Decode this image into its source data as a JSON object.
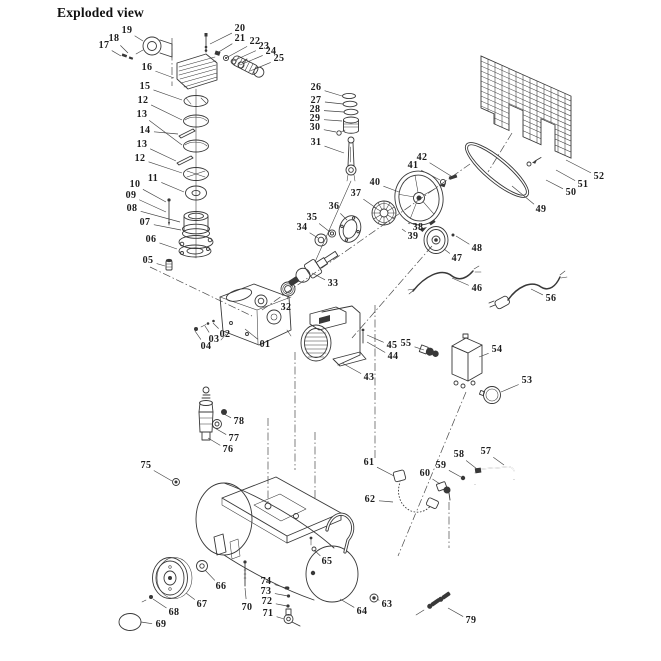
{
  "title": "Exploded view",
  "diagram": {
    "type": "exploded-parts-diagram",
    "subject": "belt-driven air compressor with horizontal tank",
    "ink_color": "#383838",
    "background_color": "#ffffff",
    "labels": [
      {
        "t": "17",
        "x": 104,
        "y": 46,
        "tx": 121,
        "ty": 56
      },
      {
        "t": "18",
        "x": 114,
        "y": 39,
        "tx": 128,
        "ty": 53
      },
      {
        "t": "19",
        "x": 127,
        "y": 31,
        "tx": 143,
        "ty": 41
      },
      {
        "t": "16",
        "x": 147,
        "y": 68,
        "tx": 174,
        "ty": 78
      },
      {
        "t": "15",
        "x": 145,
        "y": 87,
        "tx": 182,
        "ty": 100
      },
      {
        "t": "12",
        "x": 143,
        "y": 101,
        "tx": 182,
        "ty": 120
      },
      {
        "t": "13",
        "x": 142,
        "y": 115,
        "tx": 182,
        "ty": 145
      },
      {
        "t": "14",
        "x": 145,
        "y": 131,
        "tx": 178,
        "ty": 134
      },
      {
        "t": "13",
        "x": 142,
        "y": 145,
        "tx": 176,
        "ty": 161
      },
      {
        "t": "12",
        "x": 140,
        "y": 159,
        "tx": 182,
        "ty": 173
      },
      {
        "t": "11",
        "x": 153,
        "y": 179,
        "tx": 184,
        "ty": 192
      },
      {
        "t": "10",
        "x": 135,
        "y": 185,
        "tx": 166,
        "ty": 202
      },
      {
        "t": "09",
        "x": 131,
        "y": 196,
        "tx": 166,
        "ty": 212
      },
      {
        "t": "08",
        "x": 132,
        "y": 209,
        "tx": 180,
        "ty": 222
      },
      {
        "t": "07",
        "x": 145,
        "y": 223,
        "tx": 181,
        "ty": 230
      },
      {
        "t": "06",
        "x": 151,
        "y": 240,
        "tx": 177,
        "ty": 249
      },
      {
        "t": "05",
        "x": 148,
        "y": 261,
        "tx": 165,
        "ty": 266
      },
      {
        "t": "20",
        "x": 240,
        "y": 29,
        "tx": 210,
        "ty": 44
      },
      {
        "t": "21",
        "x": 240,
        "y": 39,
        "tx": 217,
        "ty": 53
      },
      {
        "t": "22",
        "x": 255,
        "y": 42,
        "tx": 226,
        "ty": 58
      },
      {
        "t": "23",
        "x": 264,
        "y": 47,
        "tx": 233,
        "ty": 61
      },
      {
        "t": "24",
        "x": 271,
        "y": 52,
        "tx": 240,
        "ty": 65
      },
      {
        "t": "25",
        "x": 279,
        "y": 59,
        "tx": 250,
        "ty": 71
      },
      {
        "t": "26",
        "x": 316,
        "y": 88,
        "tx": 342,
        "ty": 96
      },
      {
        "t": "27",
        "x": 316,
        "y": 101,
        "tx": 343,
        "ty": 104
      },
      {
        "t": "28",
        "x": 315,
        "y": 110,
        "tx": 344,
        "ty": 112
      },
      {
        "t": "29",
        "x": 315,
        "y": 119,
        "tx": 342,
        "ty": 121
      },
      {
        "t": "30",
        "x": 315,
        "y": 128,
        "tx": 336,
        "ty": 132
      },
      {
        "t": "31",
        "x": 316,
        "y": 143,
        "tx": 344,
        "ty": 153
      },
      {
        "t": "32",
        "x": 286,
        "y": 308,
        "tx": 288,
        "ty": 296
      },
      {
        "t": "33",
        "x": 333,
        "y": 284,
        "tx": 312,
        "ty": 273
      },
      {
        "t": "34",
        "x": 302,
        "y": 228,
        "tx": 318,
        "ty": 238
      },
      {
        "t": "35",
        "x": 312,
        "y": 218,
        "tx": 330,
        "ty": 232
      },
      {
        "t": "36",
        "x": 334,
        "y": 207,
        "tx": 347,
        "ty": 220
      },
      {
        "t": "37",
        "x": 356,
        "y": 194,
        "tx": 376,
        "ty": 208
      },
      {
        "t": "38",
        "x": 418,
        "y": 228,
        "tx": 408,
        "ty": 223
      },
      {
        "t": "39",
        "x": 413,
        "y": 237,
        "tx": 402,
        "ty": 229
      },
      {
        "t": "40",
        "x": 375,
        "y": 183,
        "tx": 399,
        "ty": 192
      },
      {
        "t": "41",
        "x": 413,
        "y": 166,
        "tx": 440,
        "ty": 180
      },
      {
        "t": "42",
        "x": 422,
        "y": 158,
        "tx": 451,
        "ty": 176
      },
      {
        "t": "43",
        "x": 369,
        "y": 378,
        "tx": 342,
        "ty": 363
      },
      {
        "t": "44",
        "x": 393,
        "y": 357,
        "tx": 367,
        "ty": 342
      },
      {
        "t": "45",
        "x": 392,
        "y": 346,
        "tx": 367,
        "ty": 335
      },
      {
        "t": "46",
        "x": 477,
        "y": 289,
        "tx": 452,
        "ty": 278
      },
      {
        "t": "47",
        "x": 457,
        "y": 259,
        "tx": 444,
        "ty": 249
      },
      {
        "t": "48",
        "x": 477,
        "y": 249,
        "tx": 456,
        "ty": 236
      },
      {
        "t": "49",
        "x": 541,
        "y": 210,
        "tx": 512,
        "ty": 186
      },
      {
        "t": "50",
        "x": 571,
        "y": 193,
        "tx": 546,
        "ty": 180
      },
      {
        "t": "51",
        "x": 583,
        "y": 185,
        "tx": 556,
        "ty": 170
      },
      {
        "t": "52",
        "x": 599,
        "y": 177,
        "tx": 566,
        "ty": 160
      },
      {
        "t": "53",
        "x": 527,
        "y": 381,
        "tx": 501,
        "ty": 392
      },
      {
        "t": "54",
        "x": 497,
        "y": 350,
        "tx": 479,
        "ty": 357
      },
      {
        "t": "55",
        "x": 406,
        "y": 344,
        "tx": 424,
        "ty": 350
      },
      {
        "t": "56",
        "x": 551,
        "y": 299,
        "tx": 531,
        "ty": 289
      },
      {
        "t": "57",
        "x": 486,
        "y": 452,
        "tx": 504,
        "ty": 465
      },
      {
        "t": "58",
        "x": 459,
        "y": 455,
        "tx": 477,
        "ty": 469
      },
      {
        "t": "59",
        "x": 441,
        "y": 466,
        "tx": 461,
        "ty": 477
      },
      {
        "t": "60",
        "x": 425,
        "y": 474,
        "tx": 440,
        "ty": 484
      },
      {
        "t": "61",
        "x": 369,
        "y": 463,
        "tx": 394,
        "ty": 476
      },
      {
        "t": "62",
        "x": 370,
        "y": 500,
        "tx": 393,
        "ty": 502
      },
      {
        "t": "63",
        "x": 387,
        "y": 605,
        "tx": 377,
        "ty": 599
      },
      {
        "t": "64",
        "x": 362,
        "y": 612,
        "tx": 340,
        "ty": 599
      },
      {
        "t": "65",
        "x": 327,
        "y": 562,
        "tx": 314,
        "ty": 550
      },
      {
        "t": "66",
        "x": 221,
        "y": 587,
        "tx": 205,
        "ty": 570
      },
      {
        "t": "67",
        "x": 202,
        "y": 605,
        "tx": 186,
        "ty": 593
      },
      {
        "t": "68",
        "x": 174,
        "y": 613,
        "tx": 153,
        "ty": 599
      },
      {
        "t": "69",
        "x": 161,
        "y": 625,
        "tx": 141,
        "ty": 622
      },
      {
        "t": "70",
        "x": 247,
        "y": 608,
        "tx": 245,
        "ty": 588
      },
      {
        "t": "71",
        "x": 268,
        "y": 614,
        "tx": 284,
        "ty": 619
      },
      {
        "t": "72",
        "x": 267,
        "y": 602,
        "tx": 287,
        "ty": 606
      },
      {
        "t": "73",
        "x": 266,
        "y": 592,
        "tx": 288,
        "ty": 596
      },
      {
        "t": "74",
        "x": 266,
        "y": 582,
        "tx": 286,
        "ty": 588
      },
      {
        "t": "75",
        "x": 146,
        "y": 466,
        "tx": 172,
        "ty": 481
      },
      {
        "t": "76",
        "x": 228,
        "y": 450,
        "tx": 208,
        "ty": 438
      },
      {
        "t": "77",
        "x": 234,
        "y": 439,
        "tx": 213,
        "ty": 427
      },
      {
        "t": "78",
        "x": 239,
        "y": 422,
        "tx": 222,
        "ty": 413
      },
      {
        "t": "79",
        "x": 471,
        "y": 621,
        "tx": 448,
        "ty": 608
      },
      {
        "t": "01",
        "x": 265,
        "y": 345,
        "tx": 245,
        "ty": 329
      },
      {
        "t": "02",
        "x": 225,
        "y": 335,
        "tx": 213,
        "ty": 323
      },
      {
        "t": "03",
        "x": 214,
        "y": 340,
        "tx": 205,
        "ty": 326
      },
      {
        "t": "04",
        "x": 206,
        "y": 347,
        "tx": 195,
        "ty": 331
      }
    ]
  }
}
